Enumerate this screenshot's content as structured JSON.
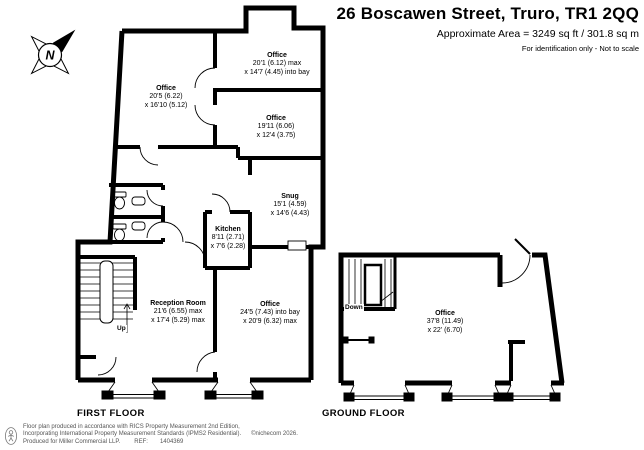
{
  "header": {
    "title": "26 Boscawen Street, Truro, TR1 2QQ",
    "area_line": "Approximate Area = 3249 sq ft / 301.8 sq m",
    "disclaimer": "For identification only - Not to scale"
  },
  "compass": {
    "north_label": "N"
  },
  "floors": {
    "first": {
      "label": "FIRST FLOOR",
      "stairs_label": "Up",
      "rooms": [
        {
          "name": "Office",
          "dim1": "20'5 (6.22)",
          "dim2": "x 16'10 (5.12)"
        },
        {
          "name": "Office",
          "dim1": "20'1 (6.12) max",
          "dim2": "x 14'7 (4.45) into bay"
        },
        {
          "name": "Office",
          "dim1": "19'11 (6.06)",
          "dim2": "x 12'4 (3.75)"
        },
        {
          "name": "Snug",
          "dim1": "15'1 (4.59)",
          "dim2": "x 14'6 (4.43)"
        },
        {
          "name": "Kitchen",
          "dim1": "8'11 (2.71)",
          "dim2": "x 7'6 (2.28)"
        },
        {
          "name": "Reception Room",
          "dim1": "21'6 (6.55) max",
          "dim2": "x 17'4 (5.29) max"
        },
        {
          "name": "Office",
          "dim1": "24'5 (7.43) into bay",
          "dim2": "x 20'9 (6.32) max"
        }
      ]
    },
    "ground": {
      "label": "GROUND FLOOR",
      "stairs_label": "Down",
      "rooms": [
        {
          "name": "Office",
          "dim1": "37'8 (11.49)",
          "dim2": "x 22' (6.70)"
        }
      ]
    }
  },
  "footer": {
    "line1": "Floor plan produced in accordance with RICS Property Measurement 2nd Edition,",
    "line2": "Incorporating International Property Measurement Standards (IPMS2 Residential).",
    "copyright": "©nichecom 2026.",
    "line3": "Produced for Miller Commercial LLP.",
    "ref_label": "REF:",
    "ref_number": "1404369"
  },
  "colors": {
    "wall": "#000000",
    "footer_text": "#555555"
  }
}
